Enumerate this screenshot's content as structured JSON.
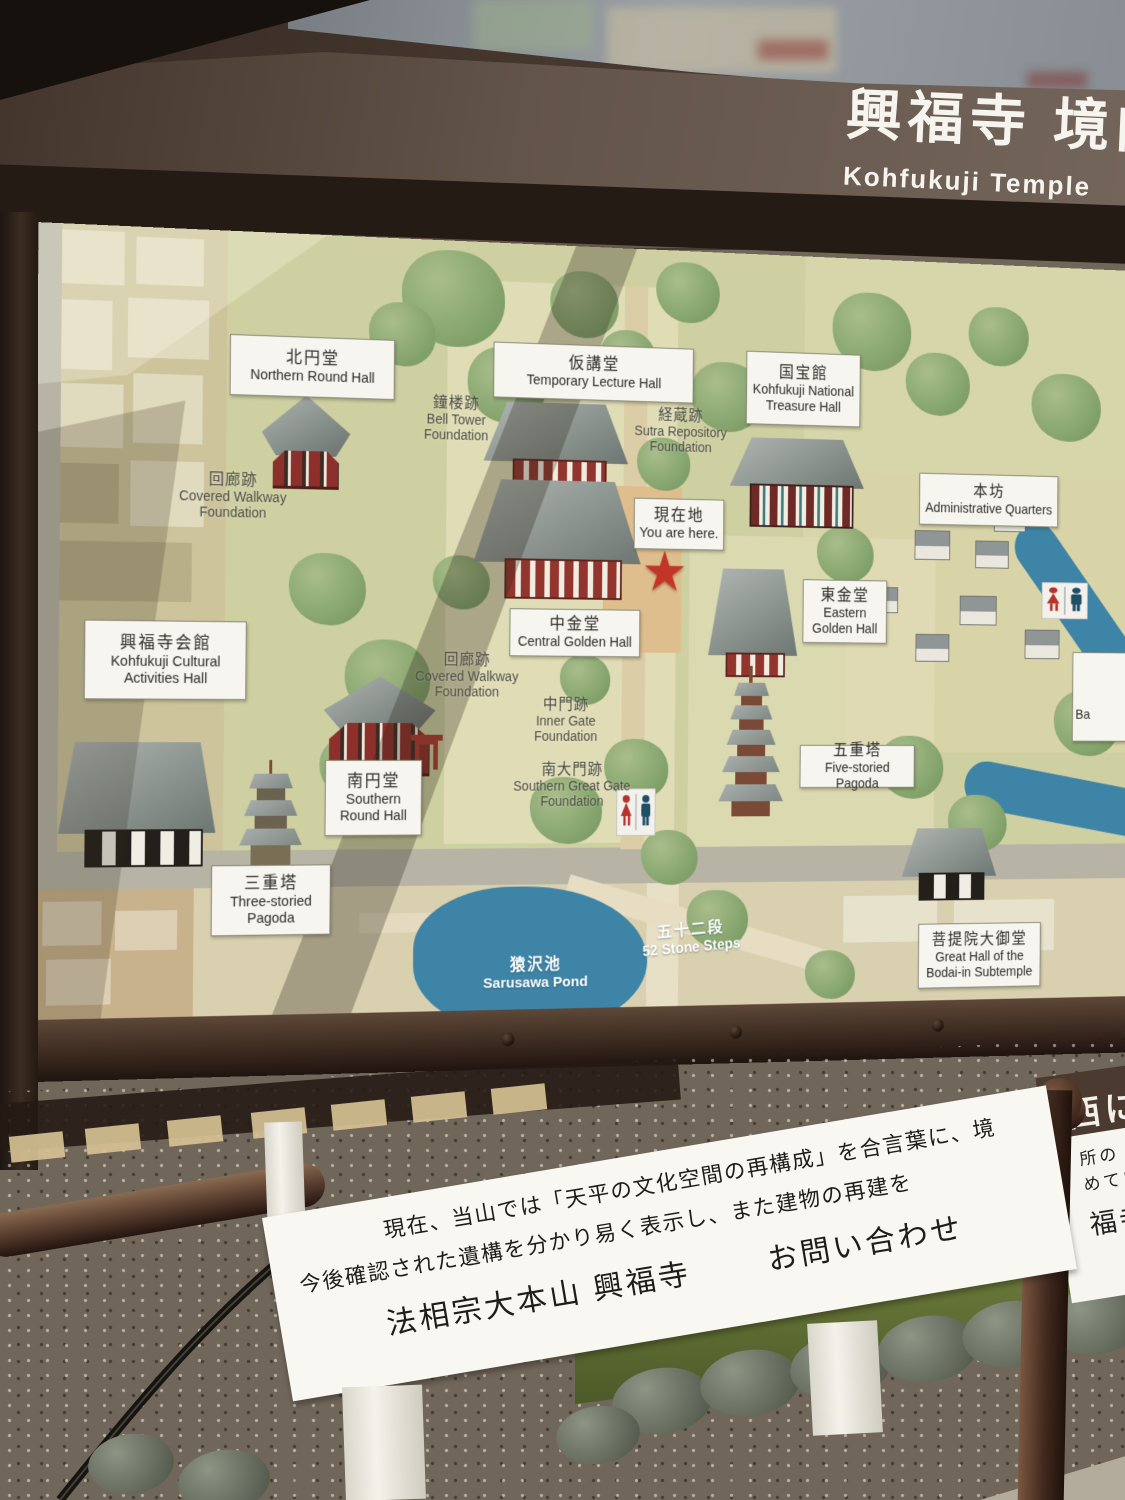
{
  "header": {
    "title_jp": "興福寺 境内",
    "title_en": "Kohfukuji Temple"
  },
  "map": {
    "boxed_labels": [
      {
        "id": "northern-round-hall",
        "jp": "北円堂",
        "en": "Northern Round Hall"
      },
      {
        "id": "temporary-lecture-hall",
        "jp": "仮講堂",
        "en": "Temporary Lecture Hall"
      },
      {
        "id": "national-treasure-hall",
        "jp": "国宝館",
        "en": "Kohfukuji National Treasure Hall"
      },
      {
        "id": "administrative-quarters",
        "jp": "本坊",
        "en": "Administrative Quarters"
      },
      {
        "id": "eastern-golden-hall",
        "jp": "東金堂",
        "en": "Eastern Golden Hall"
      },
      {
        "id": "cultural-activities-hall",
        "jp": "興福寺会館",
        "en": "Kohfukuji Cultural Activities Hall"
      },
      {
        "id": "central-golden-hall",
        "jp": "中金堂",
        "en": "Central Golden Hall"
      },
      {
        "id": "five-storied-pagoda",
        "jp": "五重塔",
        "en": "Five-storied Pagoda"
      },
      {
        "id": "southern-round-hall",
        "jp": "南円堂",
        "en": "Southern Round Hall"
      },
      {
        "id": "three-storied-pagoda",
        "jp": "三重塔",
        "en": "Three-storied Pagoda"
      },
      {
        "id": "bodai-in-great-hall",
        "jp": "菩提院大御堂",
        "en": "Great Hall of the Bodai-in Subtemple"
      }
    ],
    "you_are_here": {
      "jp": "現在地",
      "en": "You are here."
    },
    "plain_labels": [
      {
        "id": "bell-tower-foundation",
        "jp": "鐘楼跡",
        "en": "Bell Tower Foundation"
      },
      {
        "id": "covered-walkway-foundation-north",
        "jp": "回廊跡",
        "en": "Covered Walkway Foundation"
      },
      {
        "id": "sutra-repository-foundation",
        "jp": "経蔵跡",
        "en": "Sutra Repository Foundation"
      },
      {
        "id": "covered-walkway-foundation-central",
        "jp": "回廊跡",
        "en": "Covered Walkway Foundation"
      },
      {
        "id": "inner-gate-foundation",
        "jp": "中門跡",
        "en": "Inner Gate Foundation"
      },
      {
        "id": "southern-great-gate-foundation",
        "jp": "南大門跡",
        "en": "Southern Great Gate Foundation"
      }
    ],
    "water_labels": [
      {
        "id": "sarusawa-pond",
        "jp": "猿沢池",
        "en": "Sarusawa Pond"
      },
      {
        "id": "52-stone-steps",
        "jp": "五十二段",
        "en": "52 Stone Steps"
      }
    ],
    "partial_label_right": {
      "en_fragment": "Ba"
    }
  },
  "foreground_sign": {
    "line1": "現在、当山では「天平の文化空間の再構成」を合言葉に、境",
    "line2": "今後確認された遺構を分かり易く表示し、また建物の再建を",
    "line3_left": "法相宗大本山 興福寺",
    "line3_right": "お問い合わせ"
  },
  "right_signs": {
    "brown_fragment": "西に",
    "white_fragments": [
      "所の",
      "めていく",
      "福寺寺"
    ]
  },
  "icons": {
    "star_glyph": "★"
  },
  "colors": {
    "star_red": "#c23627",
    "map_green": "#cfd0a2",
    "pond_blue": "#3e84a6",
    "board_brown": "#4a3a30",
    "label_bg": "#f6f5ef"
  }
}
